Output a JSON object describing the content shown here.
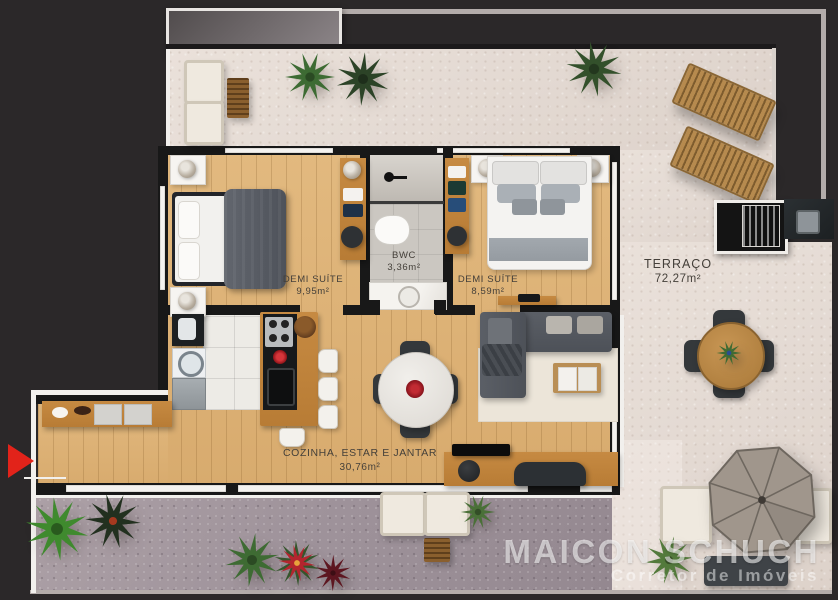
{
  "plan": {
    "rooms": {
      "suite1": {
        "name": "DEMI SUÍTE",
        "area": "9,95m²"
      },
      "bwc": {
        "name": "BWC",
        "area": "3,36m²"
      },
      "suite2": {
        "name": "DEMI SUÍTE",
        "area": "8,59m²"
      },
      "terraco": {
        "name": "TERRAÇO",
        "area": "72,27m²"
      },
      "cozinha": {
        "name": "COZINHA, ESTAR E JANTAR",
        "area": "30,76m²"
      }
    },
    "entrance_marker": "entrance-arrow"
  },
  "watermark": {
    "brand": "MAICON SCHUCH",
    "subtitle": "Corretor de Imóveis"
  },
  "colors": {
    "background": "#2b2829",
    "wall": "#181818",
    "wood_floor": "#ddb277",
    "terrace_concrete": "#e5dcd5",
    "garden_concrete": "#9e929a",
    "entrance_arrow_red": "#e2231a",
    "label_text": "#45403a",
    "watermark_white": "rgba(255,255,255,0.58)"
  }
}
